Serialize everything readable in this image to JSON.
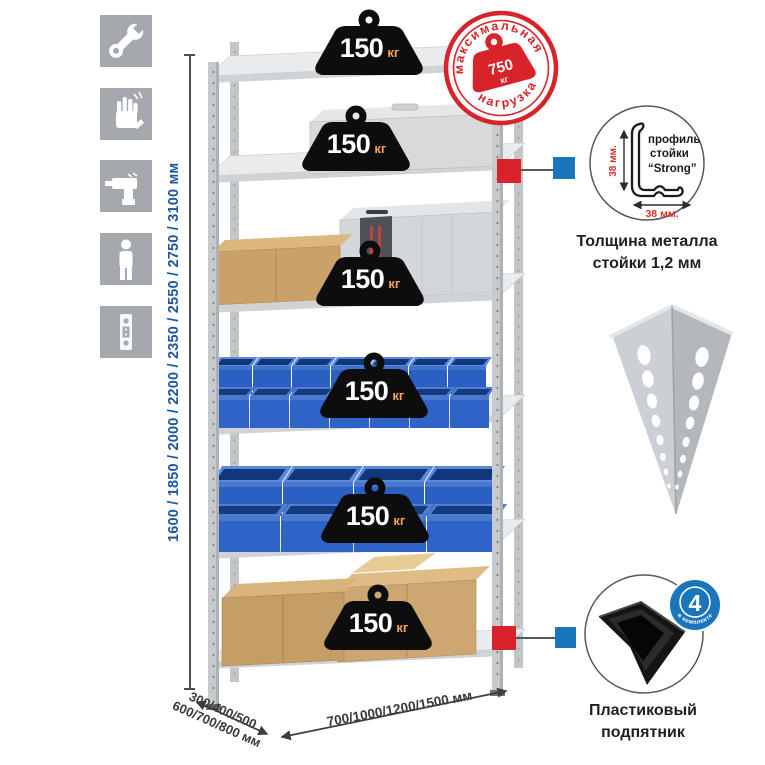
{
  "page": {
    "background": "#ffffff"
  },
  "colors": {
    "accent_red": "#d8232a",
    "accent_blue": "#1b75bc",
    "dimension_blue": "#1c57a0",
    "icon_gray": "#a5a9ad",
    "bin_blue": "#2c5fc2",
    "weight_black": "#0d0d0d",
    "load_unit_orange": "#f2a351"
  },
  "left_toolbar": {
    "icons": [
      {
        "name": "wrench-icon"
      },
      {
        "name": "gloves-icon"
      },
      {
        "name": "drill-icon"
      },
      {
        "name": "person-icon"
      },
      {
        "name": "perforated-strip-icon"
      }
    ]
  },
  "dimensions": {
    "height_values": "1600 / 1850 / 2000 / 2200 / 2350 / 2550 / 2750 / 3100 мм",
    "depth_values_line1": "300/400/500",
    "depth_values_line2": "600/700/800 мм",
    "width_values": "700/1000/1200/1500 мм"
  },
  "rack": {
    "shelf_count": 6,
    "shelf_load_value": "150",
    "shelf_load_unit": "кг"
  },
  "max_load_stamp": {
    "arc_top": "максимальная",
    "arc_bottom": "нагрузка",
    "value": "750",
    "unit": "кг"
  },
  "profile_detail": {
    "dim_vertical": "38 мм.",
    "dim_horizontal": "38 мм.",
    "label_line1": "профиль",
    "label_line2": "стойки",
    "label_line3": "“Strong”",
    "caption_line1": "Толщина металла",
    "caption_line2": "стойки 1,2 мм"
  },
  "foot_detail": {
    "badge_value": "4",
    "badge_arc": "в комплекте",
    "caption_line1": "Пластиковый",
    "caption_line2": "подпятник"
  }
}
